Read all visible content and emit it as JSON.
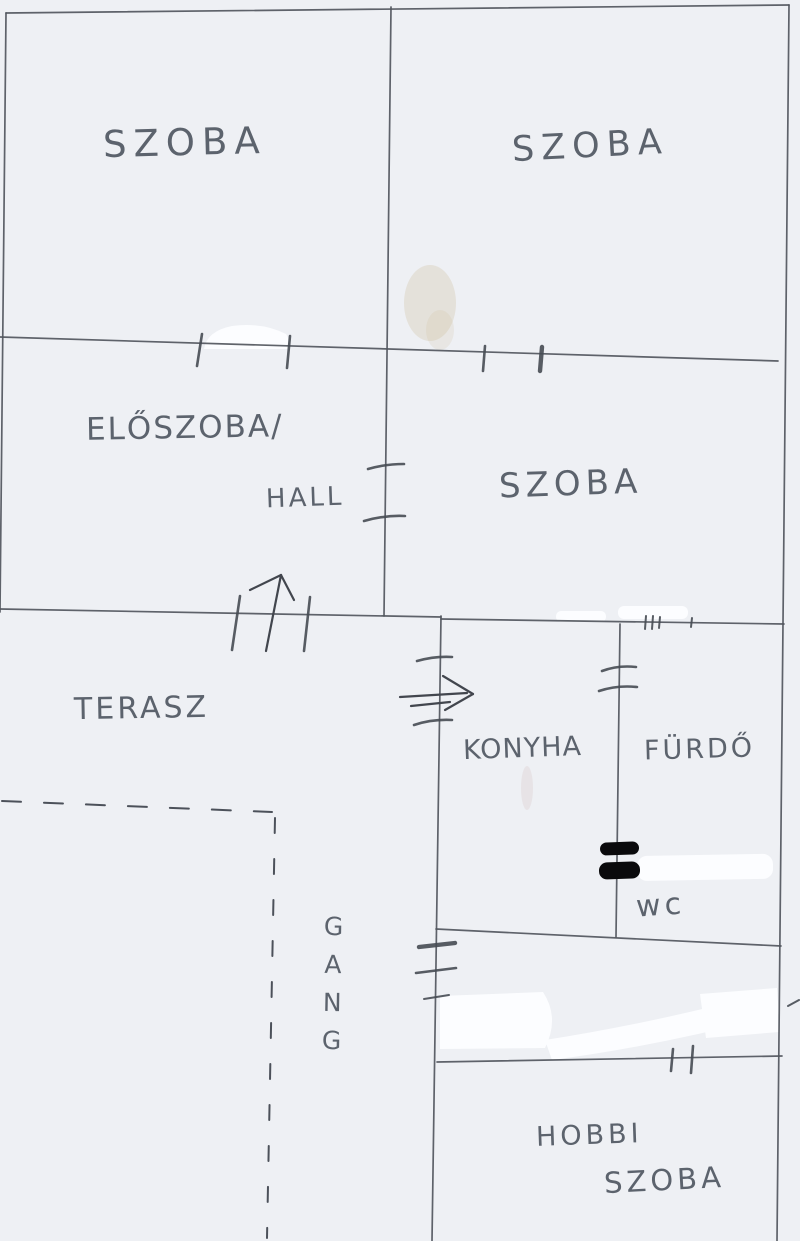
{
  "page": {
    "type": "scanned hand-drawn floor plan sketch"
  },
  "labels": {
    "szoba_top_left": "SZOBA",
    "szoba_top_right": "SZOBA",
    "eloszoba": "ELŐSZOBA/",
    "hall": "HALL",
    "szoba_middle": "SZOBA",
    "terasz": "TERASZ",
    "konyha": "KONYHA",
    "furdo": "FÜRDŐ",
    "wc": "wc",
    "gang": "GANG",
    "hobbi_line1": "HOBBI",
    "hobbi_line2": "SZOBA"
  },
  "annotations": {
    "entry_arrow": "arrow pointing up through door opening into ELŐSZOBA/HALL",
    "kitchen_arrow": "arrow pointing right through door opening into KONYHA",
    "dashed_boundary": "open edge of TERASZ / GANG drawn as dashed line",
    "redaction_bars": "two thick black marker bars on KONYHA/FÜRDŐ wall above wc",
    "door_openings": "short tick pairs across walls mark door openings"
  },
  "colors": {
    "paper": "#eef0f4",
    "ink": "#51565d",
    "handwriting": "#484e5a",
    "redaction": "#0a0a0c",
    "whiteout": "#fcfdff"
  }
}
